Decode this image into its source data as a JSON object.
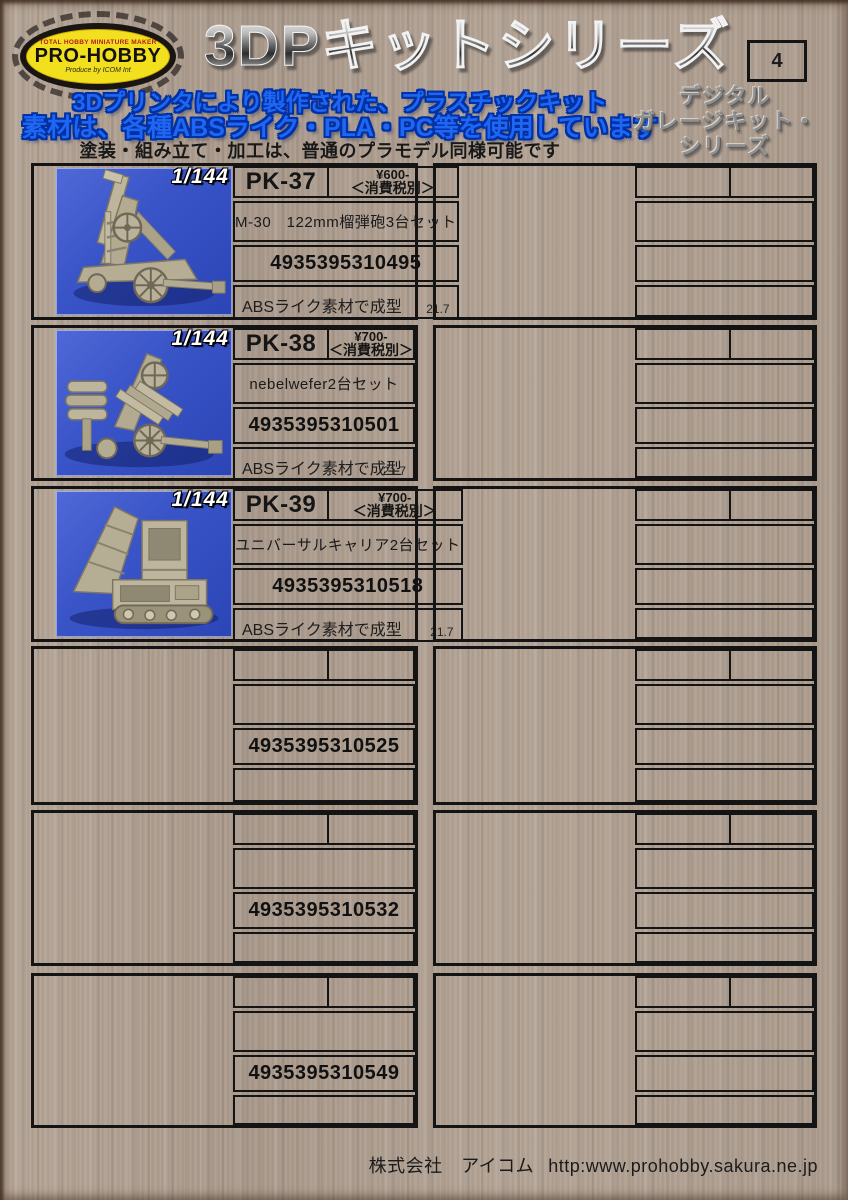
{
  "colors": {
    "photo_background": "#3a55c8",
    "logo_yellow": "#f2df1e",
    "subtitle_blue": "#1f66f2",
    "title_metal_gray": "#5a5a5a",
    "wood_background": "#b2a294"
  },
  "header": {
    "logo": {
      "brand": "PRO-HOBBY",
      "tagline_top": "TOTAL HOBBY MINIATURE MAKER",
      "tagline_bottom": "Produce by ICOM Int"
    },
    "title": "3DPキットシリーズ",
    "page_number": "4",
    "subtitle_line1": "3Dプリンタにより製作された、プラスチックキット",
    "subtitle_line2": "素材は、各種ABSライク・PLA・PC等を使用しています",
    "note": "塗装・組み立て・加工は、普通のプラモデル同様可能です",
    "series_label": [
      "デジタル",
      "ガレージキット・",
      "シリーズ"
    ]
  },
  "catalog": {
    "left_column": [
      {
        "scale": "1/144",
        "photo": "howitzer",
        "code": "PK-37",
        "price": "¥600-",
        "tax": "＜消費税別＞",
        "name": "M-30　122mm榴弾砲3台セット",
        "jan": "4935395310495",
        "material": "ABSライク素材で成型",
        "date": "21.7"
      },
      {
        "scale": "1/144",
        "photo": "nebelwerfer",
        "code": "PK-38",
        "price": "¥700-",
        "tax": "＜消費税別＞",
        "name": "nebelwefer2台セット",
        "jan": "4935395310501",
        "material": "ABSライク素材で成型",
        "date": "21.7"
      },
      {
        "scale": "1/144",
        "photo": "carrier",
        "code": "PK-39",
        "price": "¥700-",
        "tax": "＜消費税別＞",
        "name": "ユニバーサルキャリア2台セット",
        "jan": "4935395310518",
        "material": "ABSライク素材で成型",
        "date": "21.7"
      },
      {
        "jan": "4935395310525"
      },
      {
        "jan": "4935395310532"
      },
      {
        "jan": "4935395310549"
      }
    ],
    "right_column": [
      {},
      {},
      {},
      {},
      {},
      {}
    ]
  },
  "footer": {
    "company": "株式会社　アイコム",
    "url": "http:www.prohobby.sakura.ne.jp"
  }
}
